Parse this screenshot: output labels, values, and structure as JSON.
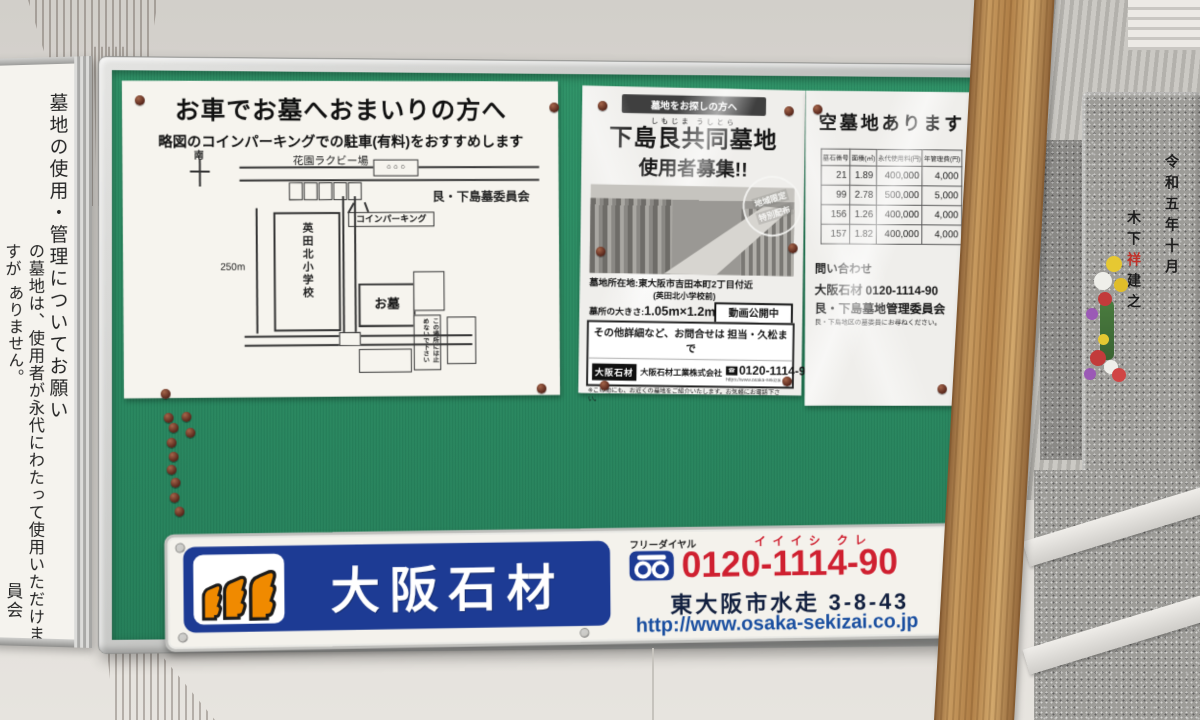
{
  "left_sign": {
    "col1": "墓地の使用・管理についてお願い",
    "col2": "の墓地は、使用者が永代にわたって使用いただけますが",
    "col3": "ありません。",
    "col4": "員会"
  },
  "parking_poster": {
    "title": "お車でお墓へおまいりの方へ",
    "subtitle": "略図のコインパーキングでの駐車(有料)をおすすめします",
    "committee": "艮・下島墓委員会",
    "map": {
      "compass": "南",
      "rugby_field": "花園ラクビー場",
      "meter": "○ ○ ○",
      "coin_parking": "コインパーキング",
      "distance": "250m",
      "school": "英田北小学校",
      "grave": "お墓",
      "no_parking_r": "この場所には止",
      "no_parking_l": "めないで下さい"
    }
  },
  "recruit_poster": {
    "banner": "墓地をお探しの方へ",
    "furigana": "しもじま うしとら",
    "title": "下島艮共同墓地",
    "subtitle": "使用者募集!!",
    "stamp_top": "地域限定",
    "stamp_bottom": "特別配布",
    "location": "墓地所在地:東大阪市吉田本町2丁目付近",
    "location_note": "(英田北小学校前)",
    "size_label": "墓所の大きさ:",
    "size_value": "1.05m×1.2m~",
    "fee_label": "永代使用料:",
    "fee_value": "40万円~",
    "fee_note1": "※永代使用料とは墓所(土地)を購入する費用ではなく、",
    "fee_note2": "お墓として使用する為の「使用権」を取得するものです。",
    "video": "動画公開中",
    "youtube": "YouTube",
    "video_search": "下島艮共同墓地",
    "sect": "宗旨宗派:仏教各派(一部宗教を除く)",
    "sect_note": "※この他にも、お近くの墓地をご紹介いたします。お気軽にお電話下さい。",
    "contact": "その他詳細など、お問合せは 担当・久松まで",
    "logo": "大阪石材",
    "company": "大阪石材工業株式会社",
    "phone": "0120-1114-90",
    "url": "https://www.osaka-sekizai.co.jp"
  },
  "vacancy_poster": {
    "title": "空墓地あります",
    "headers": [
      "墓石番号",
      "面積(㎡)",
      "永代使用料(円)",
      "年管理費(円)"
    ],
    "rows": [
      [
        "21",
        "1.89",
        "400,000",
        "4,000"
      ],
      [
        "99",
        "2.78",
        "500,000",
        "5,000"
      ],
      [
        "156",
        "1.26",
        "400,000",
        "4,000"
      ],
      [
        "157",
        "1.82",
        "400,000",
        "4,000"
      ]
    ],
    "inquiry": "問い合わせ",
    "inquiry_line1": "大阪石材 0120-1114-90",
    "inquiry_line2": "艮・下島墓地管理委員会",
    "inquiry_note": "艮・下島地区の墓委員にお尋ねください。"
  },
  "banner": {
    "logo": "大阪石材",
    "freedial": "フリーダイヤル",
    "ruby": "イイイシ クレ",
    "phone": "0120-1114-90",
    "address": "東大阪市水走 3-8-43",
    "url": "http://www.osaka-sekizai.co.jp"
  },
  "gravestone": {
    "right_col": "令和五年十月",
    "name": "木下",
    "red_char": "祥",
    "suffix": "建之"
  },
  "colors": {
    "felt_green": "#2e8e67",
    "logo_blue": "#1d3b94",
    "phone_red": "#cf2030",
    "moai_orange": "#f08a00"
  }
}
